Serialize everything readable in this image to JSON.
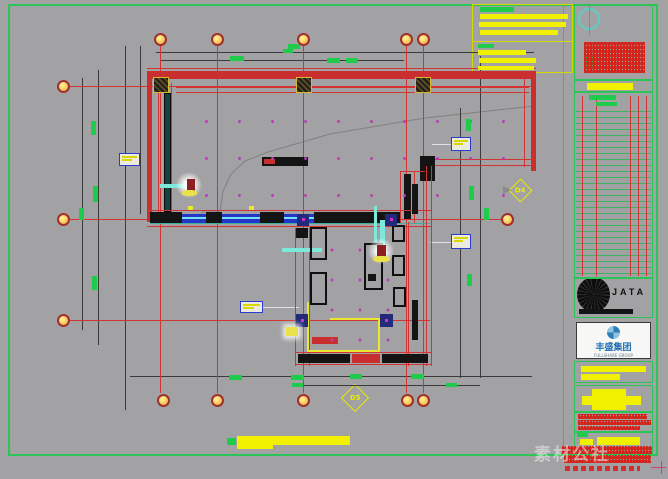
{
  "watermark": {
    "text": "素材公社"
  },
  "logos": {
    "jata": "JATA",
    "group_cn": "丰盛集团",
    "group_en": "FULLSHARE GROUP"
  },
  "markers": {
    "diamond_right_label": "D4",
    "diamond_bottom_label": "D5"
  },
  "colors": {
    "sheet_bg": "#a2a2a4",
    "frame_green": "#2bc457",
    "axis_red": "#d23434",
    "wall_red": "#c92f2f",
    "dim_green_text": "#1ecb4a",
    "note_yellow": "#f0f000",
    "downlight_magenta": "#b83cb8",
    "tag_border_blue": "#2b3bcf",
    "group_blue": "#1b6cb0"
  },
  "rects": [
    [
      156,
      52,
      378,
      1,
      "D"
    ],
    [
      161,
      60,
      243,
      1,
      "D"
    ],
    [
      130,
      376,
      402,
      1,
      "D"
    ],
    [
      300,
      385,
      180,
      1,
      "D"
    ],
    [
      98,
      70,
      1,
      275,
      "D"
    ],
    [
      82,
      78,
      1,
      252,
      "D"
    ],
    [
      125,
      46,
      1,
      364,
      "D"
    ],
    [
      140,
      46,
      1,
      168,
      "D"
    ],
    [
      460,
      108,
      1,
      270,
      "D"
    ],
    [
      480,
      56,
      1,
      322,
      "D"
    ],
    [
      432,
      144,
      20,
      1,
      "W"
    ],
    [
      430,
      242,
      22,
      1,
      "W"
    ],
    [
      263,
      307,
      36,
      1,
      "W"
    ],
    [
      160,
      46,
      1,
      347,
      "r"
    ],
    [
      217,
      46,
      1,
      347,
      "r"
    ],
    [
      303,
      46,
      1,
      347,
      "r"
    ],
    [
      406,
      46,
      1,
      347,
      "r"
    ],
    [
      423,
      46,
      1,
      347,
      "r"
    ],
    [
      70,
      86,
      466,
      1,
      "r"
    ],
    [
      70,
      219,
      431,
      1,
      "r"
    ],
    [
      70,
      320,
      360,
      1,
      "r"
    ],
    [
      147,
      68,
      389,
      1,
      "r"
    ],
    [
      147,
      71,
      389,
      8,
      "R"
    ],
    [
      176,
      87,
      353,
      1,
      "r"
    ],
    [
      176,
      92,
      353,
      1,
      "r"
    ],
    [
      147,
      71,
      5,
      151,
      "R"
    ],
    [
      158,
      79,
      1,
      133,
      "r"
    ],
    [
      171,
      83,
      1,
      129,
      "r"
    ],
    [
      164,
      93,
      7,
      119,
      "T"
    ],
    [
      531,
      71,
      5,
      100,
      "R"
    ],
    [
      524,
      79,
      1,
      88,
      "r"
    ],
    [
      424,
      159,
      112,
      1,
      "r"
    ],
    [
      424,
      165,
      108,
      1,
      "r"
    ],
    [
      420,
      156,
      15,
      25,
      "K"
    ],
    [
      400,
      171,
      25,
      1,
      "r"
    ],
    [
      400,
      171,
      1,
      52,
      "r"
    ],
    [
      414,
      171,
      1,
      52,
      "r"
    ],
    [
      404,
      174,
      7,
      45,
      "K"
    ],
    [
      262,
      157,
      46,
      9,
      "K"
    ],
    [
      264,
      159,
      11,
      5,
      "R"
    ],
    [
      147,
      210,
      285,
      1,
      "r"
    ],
    [
      147,
      226,
      285,
      1,
      "r"
    ],
    [
      150,
      212,
      32,
      12,
      "K"
    ],
    [
      182,
      214,
      24,
      9,
      "B"
    ],
    [
      206,
      212,
      16,
      12,
      "K"
    ],
    [
      222,
      214,
      38,
      9,
      "B"
    ],
    [
      260,
      212,
      24,
      12,
      "K"
    ],
    [
      284,
      214,
      30,
      9,
      "B"
    ],
    [
      314,
      212,
      86,
      12,
      "K"
    ],
    [
      150,
      223,
      280,
      1,
      "g"
    ],
    [
      188,
      206,
      5,
      4,
      "Y"
    ],
    [
      249,
      206,
      5,
      4,
      "Y"
    ],
    [
      295,
      228,
      1,
      138,
      "r"
    ],
    [
      309,
      228,
      1,
      138,
      "r"
    ],
    [
      296,
      228,
      12,
      10,
      "K"
    ],
    [
      408,
      222,
      1,
      144,
      "r"
    ],
    [
      426,
      166,
      1,
      200,
      "r"
    ],
    [
      431,
      166,
      1,
      200,
      "r"
    ],
    [
      412,
      184,
      6,
      30,
      "K"
    ],
    [
      412,
      300,
      6,
      40,
      "K"
    ],
    [
      295,
      352,
      137,
      1,
      "r"
    ],
    [
      295,
      364,
      137,
      1,
      "r"
    ],
    [
      298,
      354,
      52,
      9,
      "K"
    ],
    [
      352,
      354,
      28,
      9,
      "R"
    ],
    [
      382,
      354,
      46,
      9,
      "K"
    ],
    [
      307,
      302,
      2,
      50,
      "Y"
    ],
    [
      307,
      350,
      73,
      2,
      "Y"
    ],
    [
      330,
      318,
      50,
      2,
      "Y"
    ],
    [
      378,
      318,
      2,
      34,
      "Y"
    ],
    [
      312,
      337,
      26,
      7,
      "R"
    ],
    [
      368,
      274,
      8,
      7,
      "K"
    ],
    [
      380,
      220,
      5,
      40,
      "C"
    ],
    [
      160,
      184,
      28,
      4,
      "C"
    ],
    [
      282,
      248,
      40,
      4,
      "C"
    ],
    [
      374,
      206,
      3,
      36,
      "C"
    ],
    [
      227,
      438,
      9,
      7,
      "G"
    ],
    [
      237,
      436,
      113,
      9,
      "Yb"
    ],
    [
      237,
      445,
      36,
      4,
      "Yb"
    ],
    [
      651,
      467,
      15,
      1,
      "P"
    ],
    [
      661,
      461,
      1,
      13,
      "P"
    ]
  ],
  "furniture_outlines": [
    [
      310,
      227,
      17,
      33
    ],
    [
      310,
      272,
      17,
      33
    ],
    [
      364,
      243,
      19,
      47
    ],
    [
      392,
      225,
      13,
      17
    ],
    [
      392,
      255,
      13,
      21
    ],
    [
      393,
      287,
      13,
      20
    ]
  ],
  "navy_blocks": [
    [
      297,
      214,
      12,
      12
    ],
    [
      385,
      214,
      12,
      12
    ],
    [
      296,
      314,
      12,
      13
    ],
    [
      380,
      314,
      13,
      13
    ]
  ],
  "column_markers": [
    [
      153,
      77,
      16,
      16
    ],
    [
      296,
      77,
      16,
      16
    ],
    [
      415,
      77,
      16,
      16
    ]
  ],
  "green_texts": [
    [
      230,
      56,
      14,
      5
    ],
    [
      288,
      44,
      12,
      5
    ],
    [
      327,
      58,
      13,
      5
    ],
    [
      346,
      58,
      12,
      5
    ],
    [
      283,
      49,
      10,
      4
    ],
    [
      91,
      121,
      5,
      14
    ],
    [
      93,
      186,
      5,
      16
    ],
    [
      79,
      208,
      5,
      12
    ],
    [
      92,
      276,
      5,
      14
    ],
    [
      466,
      119,
      5,
      12
    ],
    [
      469,
      186,
      5,
      14
    ],
    [
      484,
      208,
      5,
      12
    ],
    [
      467,
      274,
      5,
      12
    ],
    [
      229,
      375,
      13,
      5
    ],
    [
      291,
      375,
      13,
      5
    ],
    [
      350,
      374,
      12,
      5
    ],
    [
      411,
      374,
      13,
      5
    ],
    [
      292,
      383,
      11,
      4
    ],
    [
      446,
      383,
      11,
      4
    ]
  ],
  "tags": [
    [
      119,
      153,
      21,
      13
    ],
    [
      451,
      137,
      20,
      14
    ],
    [
      451,
      234,
      20,
      15
    ],
    [
      240,
      301,
      23,
      12
    ]
  ],
  "bubbles": {
    "top": {
      "y": 39,
      "x": [
        160,
        217,
        303,
        406,
        423
      ]
    },
    "bottom": {
      "y": 400,
      "x": [
        163,
        217,
        303,
        407,
        423
      ]
    },
    "left": {
      "x": 63,
      "y": [
        86,
        219,
        320
      ]
    },
    "right": [
      {
        "x": 507,
        "y": 219
      }
    ]
  },
  "notes_box": {
    "bars": [
      [
        480,
        7,
        34,
        5,
        "G"
      ],
      [
        480,
        14,
        88,
        5,
        "Yb"
      ],
      [
        479,
        22,
        87,
        5,
        "Yb"
      ],
      [
        480,
        30,
        78,
        5,
        "Yb"
      ],
      [
        478,
        44,
        16,
        4,
        "G"
      ],
      [
        478,
        50,
        48,
        5,
        "Yb"
      ],
      [
        479,
        58,
        57,
        5,
        "Yb"
      ],
      [
        478,
        66,
        56,
        4,
        "Yb"
      ]
    ]
  },
  "title_block": {
    "frames": [
      [
        574,
        4,
        79,
        76
      ],
      [
        574,
        80,
        79,
        12
      ],
      [
        574,
        92,
        79,
        186
      ],
      [
        574,
        278,
        79,
        40
      ],
      [
        574,
        361,
        79,
        22
      ],
      [
        574,
        385,
        79,
        27
      ],
      [
        574,
        412,
        79,
        20
      ],
      [
        574,
        432,
        79,
        24
      ]
    ],
    "items": [
      [
        589,
        5,
        1,
        31,
        "G"
      ],
      [
        586,
        57,
        8,
        10,
        "G"
      ],
      [
        587,
        83,
        46,
        7,
        "Yb"
      ],
      [
        589,
        95,
        27,
        5,
        "G"
      ],
      [
        596,
        102,
        21,
        4,
        "G"
      ],
      [
        579,
        309,
        54,
        5,
        "K"
      ],
      [
        581,
        366,
        65,
        6,
        "Yb"
      ],
      [
        581,
        374,
        39,
        6,
        "Yb"
      ],
      [
        592,
        389,
        34,
        21,
        "Yb"
      ],
      [
        582,
        396,
        59,
        9,
        "Yb"
      ],
      [
        577,
        433,
        11,
        4,
        "G"
      ],
      [
        580,
        439,
        13,
        6,
        "Yb"
      ],
      [
        597,
        437,
        43,
        8,
        "Yb"
      ]
    ],
    "hatches": [
      [
        584,
        42,
        61,
        31
      ],
      [
        578,
        414,
        69,
        5
      ],
      [
        578,
        420,
        73,
        5
      ],
      [
        578,
        426,
        62,
        4
      ],
      [
        562,
        446,
        90,
        8
      ],
      [
        564,
        455,
        87,
        8
      ]
    ],
    "hatch_sparse": [
      [
        565,
        466,
        75,
        5
      ]
    ],
    "table": {
      "cols_x": [
        582,
        596,
        630,
        638,
        646
      ],
      "col_y": 96,
      "col_h": 180,
      "rows_area": [
        576,
        108,
        75,
        166
      ]
    }
  },
  "downlight_fields": [
    {
      "cls": "dots1",
      "rect": [
        182,
        96,
        336,
        112
      ]
    },
    {
      "cls": "dots2",
      "rect": [
        312,
        230,
        84,
        118
      ]
    }
  ],
  "fixtures": [
    {
      "glow": [
        176,
        172,
        26,
        26
      ],
      "core": [
        187,
        179,
        8,
        12
      ],
      "base": [
        182,
        190,
        15,
        6
      ]
    },
    {
      "glow": [
        368,
        238,
        26,
        26
      ],
      "core": [
        377,
        245,
        9,
        12
      ],
      "base": [
        373,
        256,
        17,
        6
      ]
    }
  ],
  "small_glow": [
    286,
    327,
    12,
    9
  ]
}
